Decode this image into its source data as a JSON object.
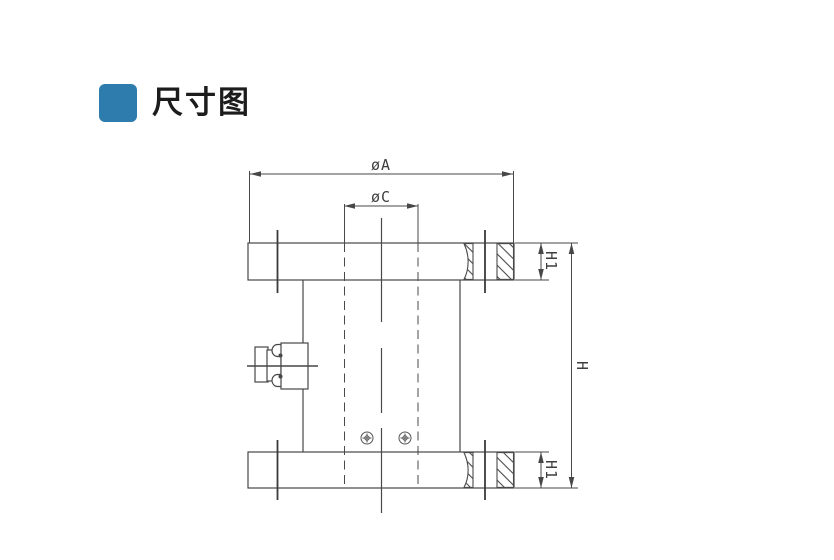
{
  "header": {
    "title": "尺寸图",
    "accent_color": "#2e7cad"
  },
  "diagram": {
    "type": "technical-dimension-drawing",
    "subject": "flange-column-load-cell-side-view",
    "line_color": "#474747",
    "labels": {
      "outer_diameter": "øA",
      "bolt_circle_diameter": "øC",
      "total_height": "H",
      "flange_thickness_top": "H1",
      "flange_thickness_bottom": "H1"
    }
  }
}
